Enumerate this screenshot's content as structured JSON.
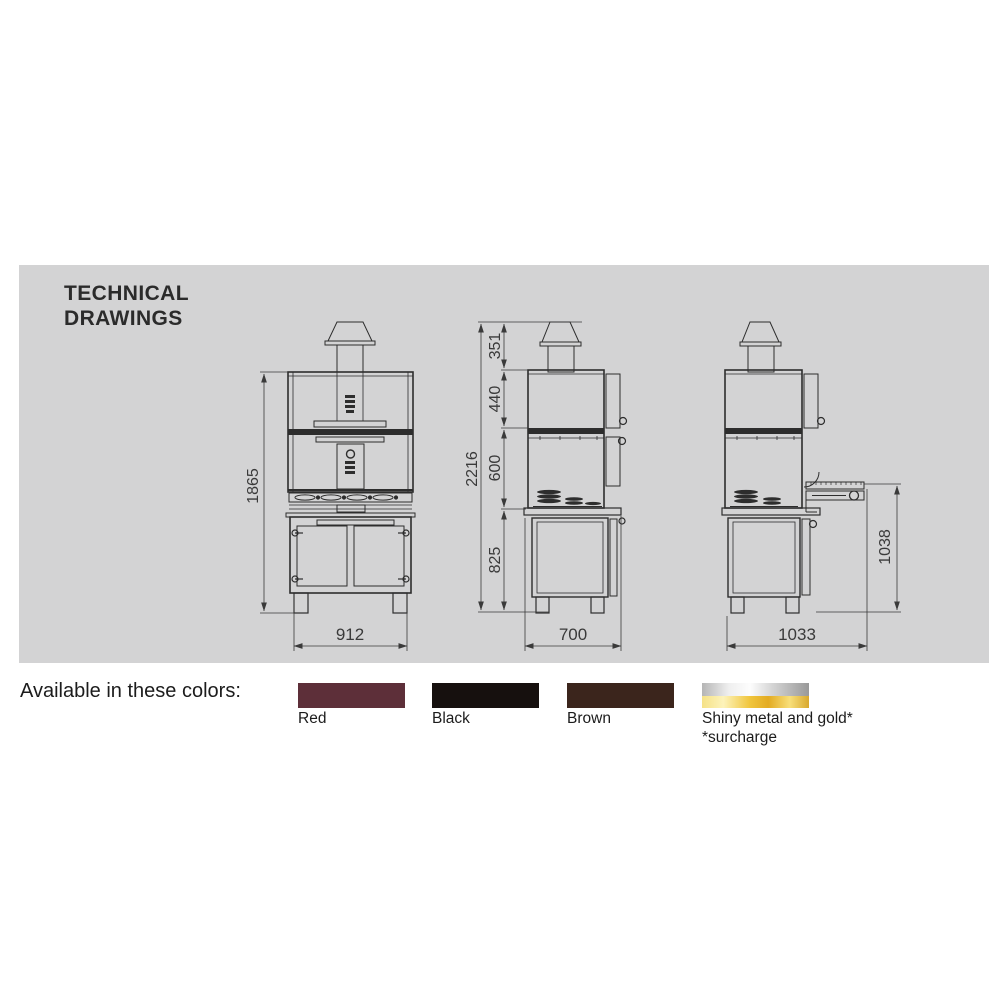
{
  "theme": {
    "panel_background": "#d3d3d4",
    "line_color": "#2d2d2d"
  },
  "section_title": {
    "line1": "TECHNICAL",
    "line2": "DRAWINGS"
  },
  "drawings": {
    "front_view": {
      "overall_height_mm": "1865",
      "overall_width_mm": "912"
    },
    "side_view": {
      "total_height_mm": "2216",
      "chimney_height_mm": "351",
      "upper_oven_height_mm": "440",
      "lower_oven_height_mm": "600",
      "base_height_mm": "825",
      "depth_mm": "700"
    },
    "side_view_open": {
      "worktop_height_mm": "1038",
      "depth_with_open_door_mm": "1033"
    }
  },
  "colors_section": {
    "heading": "Available in these colors:",
    "swatches": [
      {
        "label": "Red",
        "color": "#5d2f39"
      },
      {
        "label": "Black",
        "color": "#16100e"
      },
      {
        "label": "Brown",
        "color": "#3b251c"
      },
      {
        "label": "Shiny metal and gold*",
        "note": "*surcharge",
        "metal_gradient": "linear-gradient(90deg,#b5b5b5 0%,#efefef 25%,#fdfdfd 45%,#d6d6d6 65%,#999999 100%)",
        "gold_gradient": "linear-gradient(90deg,#f5e187 0%,#fdf3ba 20%,#f0c53c 45%,#e3ab22 62%,#f8df7a 82%,#d8a82e 100%)"
      }
    ]
  }
}
